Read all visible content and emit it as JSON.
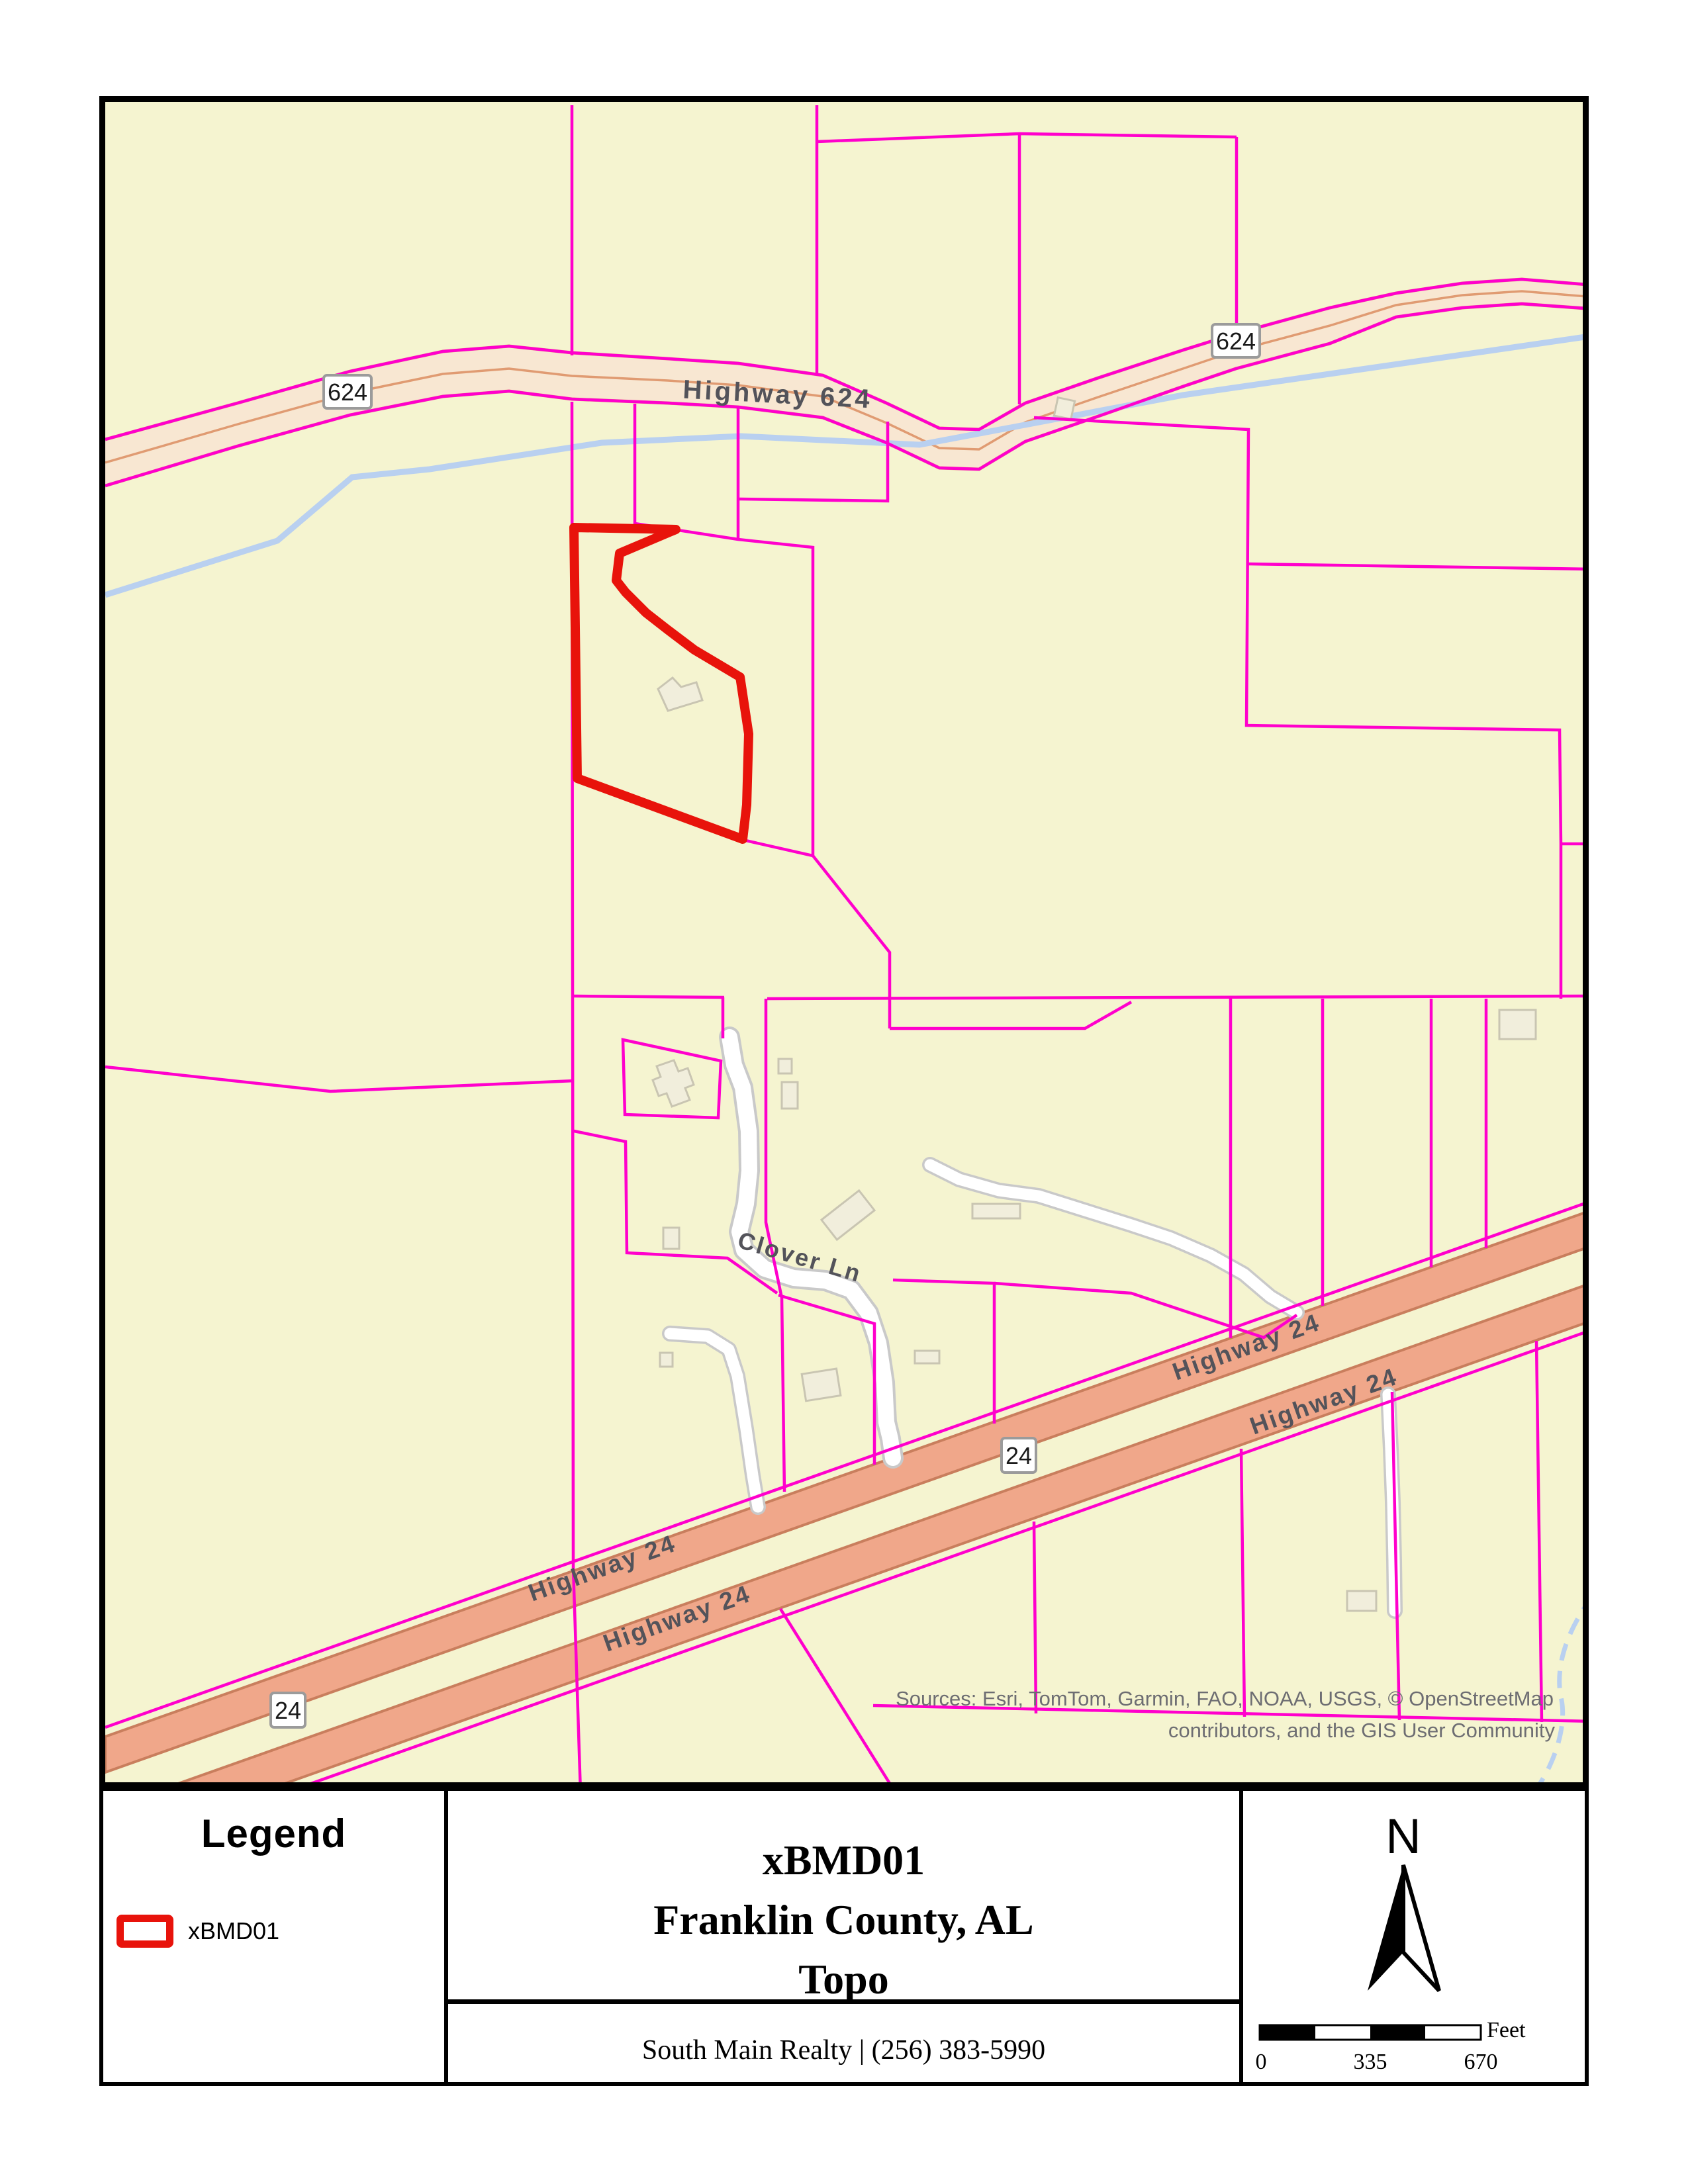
{
  "title_block": {
    "line1": "xBMD01",
    "line2": "Franklin County, AL",
    "line3": "Topo",
    "footer": "South Main Realty | (256) 383-5990"
  },
  "legend": {
    "title": "Legend",
    "items": [
      {
        "label": "xBMD01",
        "swatch_color": "#E8130B"
      }
    ]
  },
  "north_panel": {
    "north_label": "N",
    "scale_bar": {
      "ticks": [
        "0",
        "335",
        "670"
      ],
      "unit": "Feet"
    }
  },
  "map": {
    "labels": {
      "highway_624": "Highway 624",
      "highway_24": "Highway 24",
      "clover_ln": "Clover Ln"
    },
    "shields": {
      "route_624": "624",
      "route_24": "24"
    },
    "sources_line1": "Sources: Esri, TomTom, Garmin, FAO, NOAA, USGS, © OpenStreetMap",
    "sources_line2": "contributors, and the GIS User Community",
    "subject_parcel": "xBMD01",
    "colors": {
      "map_background": "#F5F4D0",
      "parcel_line": "#FF00CC",
      "subject_outline": "#E8130B",
      "highway624_fill": "#F8E7D2",
      "highway624_casing": "#E09B72",
      "highway24_fill": "#F0A78A",
      "highway24_casing": "#C97E5D",
      "stream": "#B9D0F0",
      "local_road": "#FFFFFF",
      "building_fill": "#F1EEDC",
      "road_label": "#53535A"
    }
  }
}
